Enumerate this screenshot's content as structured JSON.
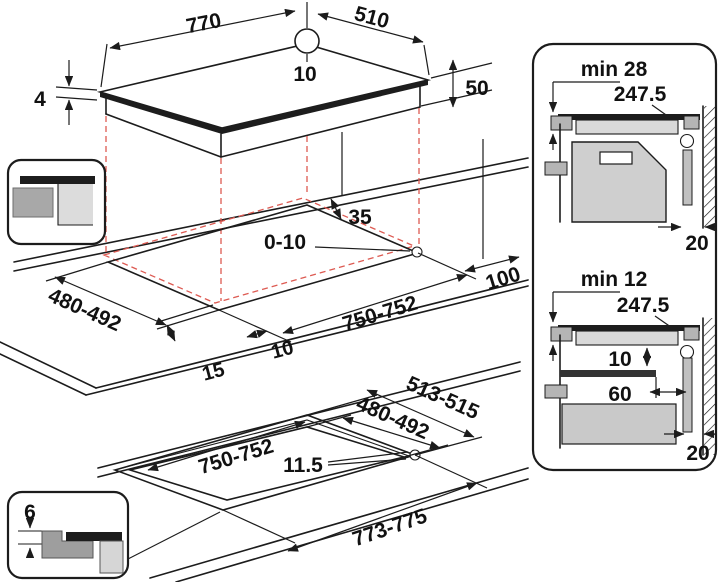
{
  "hob": {
    "width": "770",
    "depth": "510",
    "hole_offset": "10",
    "glass_thickness": "4",
    "body_height": "50"
  },
  "cutout": {
    "back_clearance": "35",
    "edge_gap": "0-10",
    "depth": "480-492",
    "width": "750-752",
    "right_clearance": "100",
    "front_overhang": "15",
    "side_overhang": "10"
  },
  "flush": {
    "recess_depth": "513-515",
    "cutout_depth": "480-492",
    "cutout_width": "750-752",
    "step_width": "11.5",
    "recess_width": "773-775"
  },
  "icon_flush": {
    "step_depth": "6"
  },
  "section_top": {
    "min_clearance": "min 28",
    "center_distance": "247.5",
    "wall_gap": "20"
  },
  "section_bottom": {
    "min_clearance": "min 12",
    "center_distance": "247.5",
    "board_gap": "10",
    "shelf_setback": "60",
    "wall_gap": "20"
  },
  "colors": {
    "line": "#1c1c1c",
    "dashed": "#dd5a52",
    "dark_bar": "#1d1d1d",
    "gray_medium": "#a8a8a8",
    "gray_light": "#d9d9d9"
  }
}
